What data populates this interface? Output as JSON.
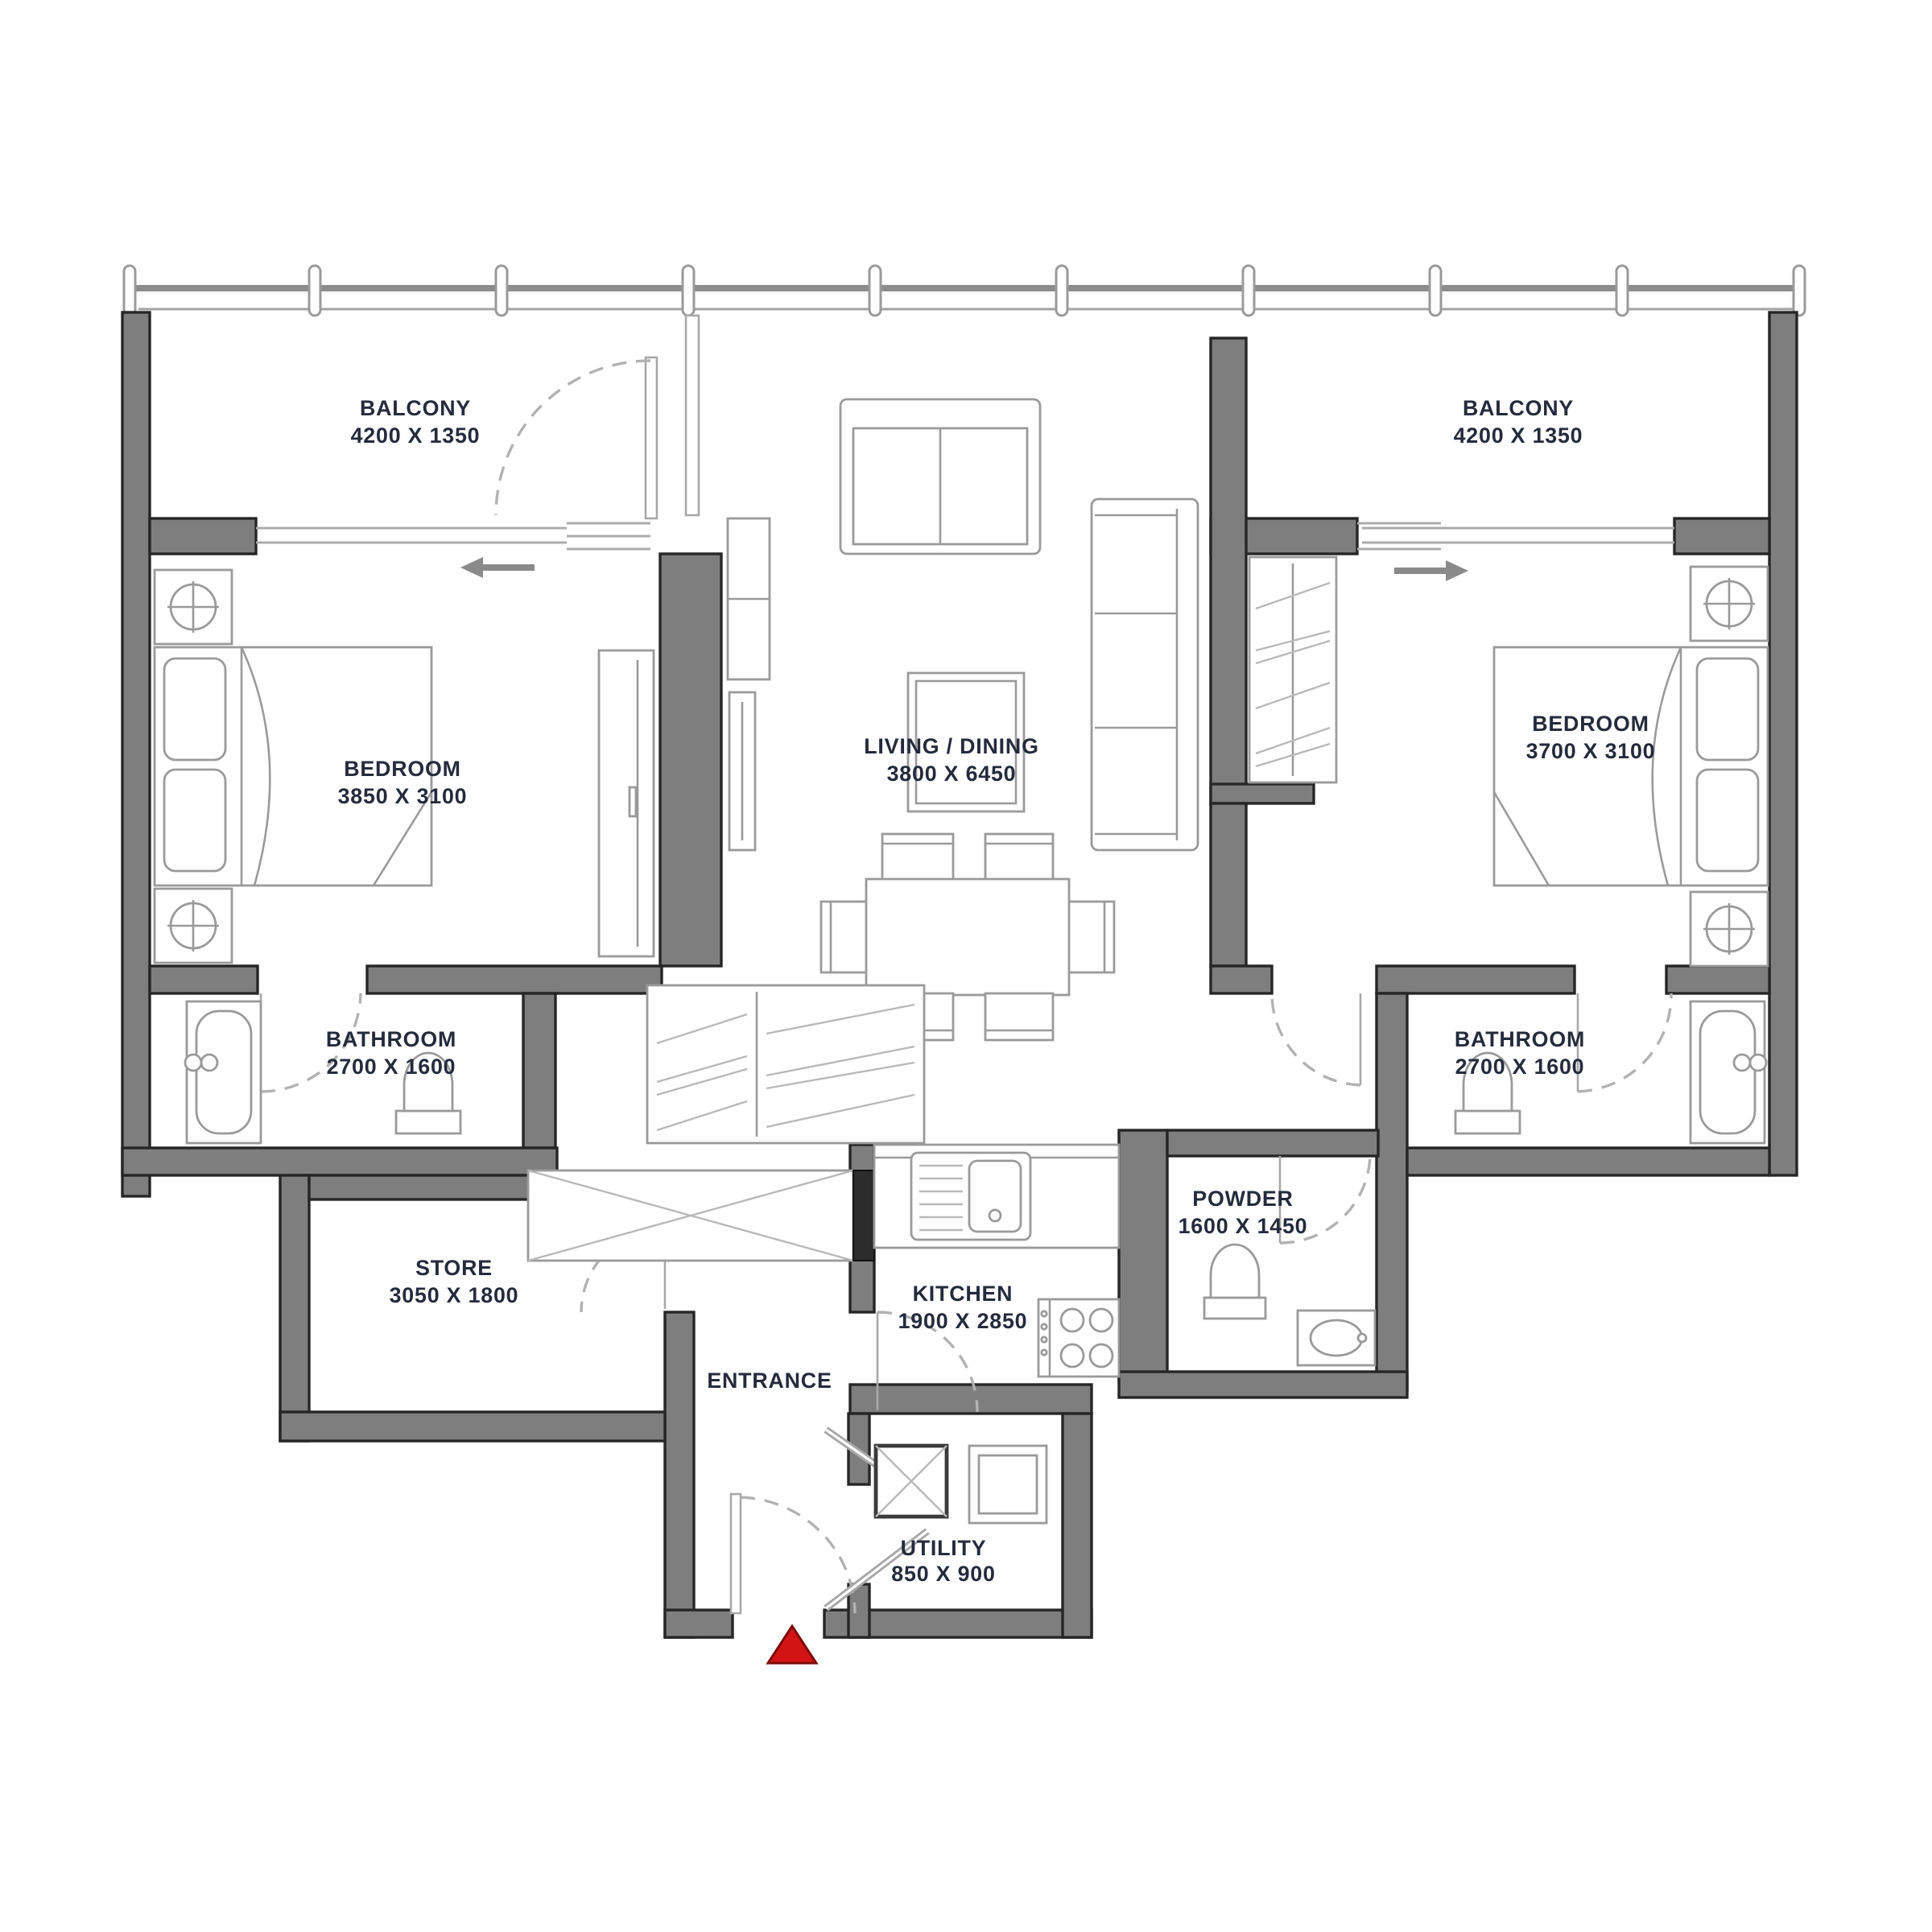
{
  "plan": {
    "title": "2 bedroom apartment floor plan",
    "rooms": {
      "balcony_left": {
        "name": "BALCONY",
        "dims": "4200 X 1350"
      },
      "balcony_right": {
        "name": "BALCONY",
        "dims": "4200 X 1350"
      },
      "bedroom_left": {
        "name": "BEDROOM",
        "dims": "3850 X 3100"
      },
      "bedroom_right": {
        "name": "BEDROOM",
        "dims": "3700 X 3100"
      },
      "living": {
        "name": "LIVING / DINING",
        "dims": "3800 X 6450"
      },
      "bathroom_left": {
        "name": "BATHROOM",
        "dims": "2700 X 1600"
      },
      "bathroom_right": {
        "name": "BATHROOM",
        "dims": "2700 X 1600"
      },
      "store": {
        "name": "STORE",
        "dims": "3050 X 1800"
      },
      "kitchen": {
        "name": "KITCHEN",
        "dims": "1900 X 2850"
      },
      "powder": {
        "name": "POWDER",
        "dims": "1600 X 1450"
      },
      "utility": {
        "name": "UTILITY",
        "dims": "850 X 900"
      },
      "entrance": {
        "name": "ENTRANCE"
      }
    },
    "colors": {
      "wall": "#7e7e7e",
      "wall_outline": "#262626",
      "label": "#252b3d",
      "furniture": "#9a9a9a",
      "dashed": "#b2b2b2",
      "entrance_marker": "#d31414"
    }
  }
}
